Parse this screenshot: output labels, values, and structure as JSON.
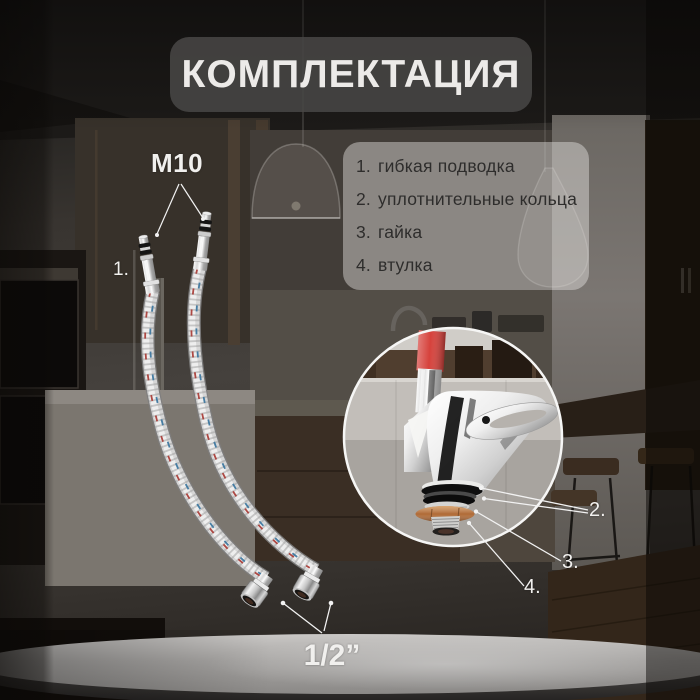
{
  "title": "КОМПЛЕКТАЦИЯ",
  "parts_list": {
    "items": [
      {
        "num": "1.",
        "label": "гибкая подводка"
      },
      {
        "num": "2.",
        "label": "уплотнительные кольца"
      },
      {
        "num": "3.",
        "label": "гайка"
      },
      {
        "num": "4.",
        "label": "втулка"
      }
    ]
  },
  "labels": {
    "top_thread": "M10",
    "bottom_thread": "1/2”",
    "hose_number": "1.",
    "callout_rings": "2.",
    "callout_nut": "3.",
    "callout_bushing": "4."
  },
  "colors": {
    "accent_red": "#d6423c",
    "brass": "#b06a35",
    "label_white": "#f1f0ee",
    "panel_text": "#2e2d2c",
    "chrome_light": "#f2f2f2"
  }
}
